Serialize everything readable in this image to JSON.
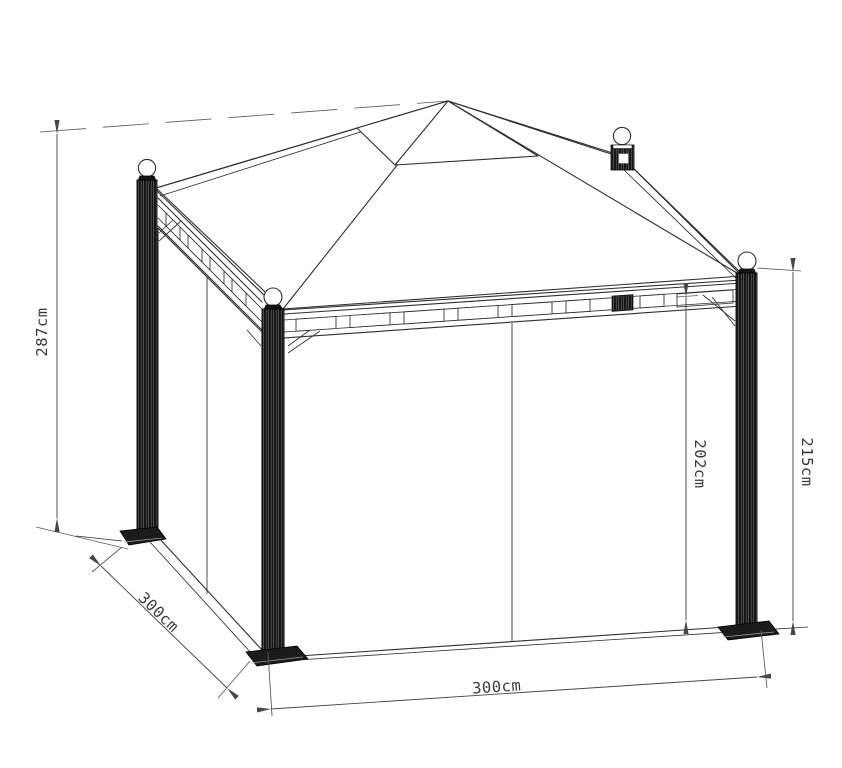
{
  "drawing": {
    "type": "technical-line-drawing",
    "subject": "metal gazebo with canopy roof, lattice eave beams and side curtains",
    "units": "cm",
    "dimensions": {
      "overall_height": {
        "label": "287cm",
        "value": 287
      },
      "side_depth": {
        "label": "300cm",
        "value": 300
      },
      "front_width": {
        "label": "300cm",
        "value": 300
      },
      "clearance_under_beam": {
        "label": "202cm",
        "value": 202
      },
      "post_height": {
        "label": "215cm",
        "value": 215
      }
    },
    "colors": {
      "background": "#ffffff",
      "linework": "#2e2e2e",
      "dimension_lines": "#474747",
      "dimension_text": "#3a3a3a",
      "posts": "#161616"
    }
  }
}
